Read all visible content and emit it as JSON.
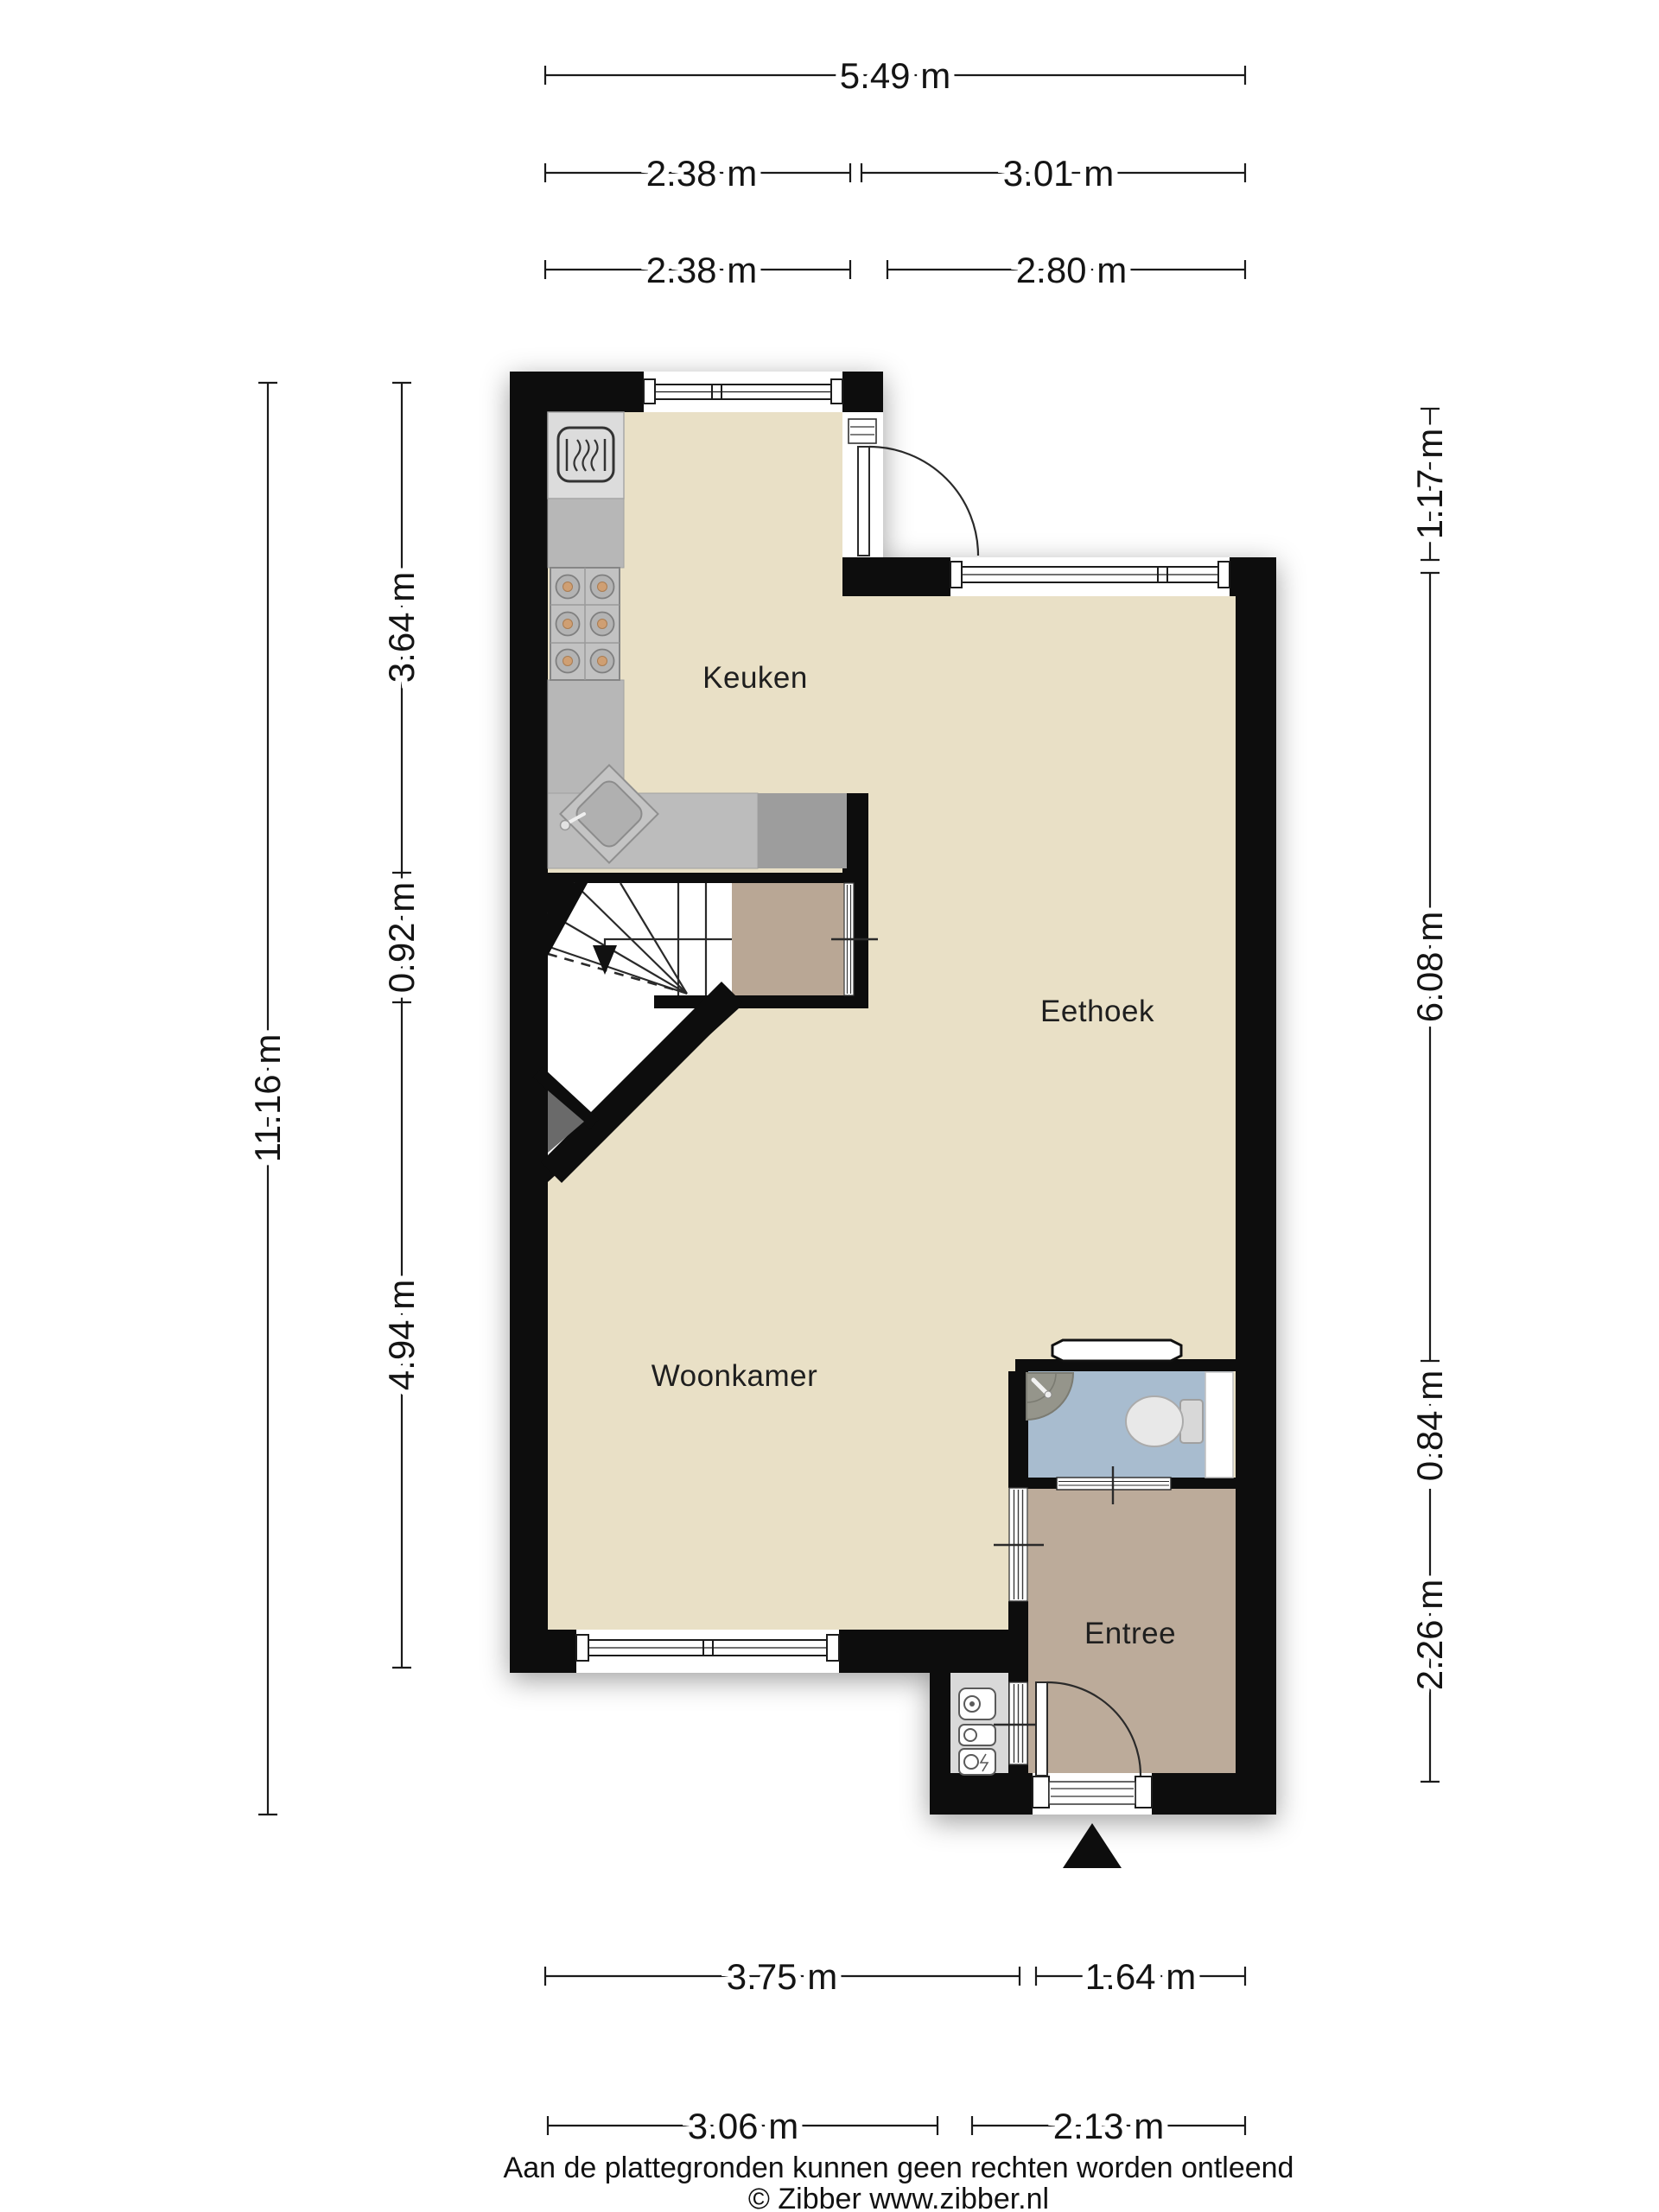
{
  "floor_plan": {
    "rooms": {
      "kitchen": "Keuken",
      "dining": "Eethoek",
      "living": "Woonkamer",
      "entry": "Entree"
    },
    "dimensions": {
      "top_total": "5.49 m",
      "top_left_a": "2.38 m",
      "top_right_a": "3.01 m",
      "top_left_b": "2.38 m",
      "top_right_b": "2.80 m",
      "left_total": "11.16 m",
      "left_kitchen": "3.64 m",
      "left_stairs": "0.92 m",
      "left_living": "4.94 m",
      "right_step": "1.17 m",
      "right_dining": "6.08 m",
      "right_toilet": "0.84 m",
      "right_entry": "2.26 m",
      "bottom_living_a": "3.75 m",
      "bottom_entry_a": "1.64 m",
      "bottom_living_b": "3.06 m",
      "bottom_entry_b": "2.13 m"
    },
    "footer": {
      "disclaimer": "Aan de plattegronden kunnen geen rechten worden ontleend",
      "copyright": "© Zibber www.zibber.nl"
    },
    "colors": {
      "wall": "#0d0d0d",
      "floor_main": "#e9e0c6",
      "floor_entry": "#bcab9a",
      "floor_closet": "#b9a795",
      "floor_toilet": "#a8bccf",
      "floor_meter": "#d9d9d9",
      "counter": "#b9b9b9",
      "counter_light": "#dcdcdc",
      "counter_dark": "#9d9d9d",
      "stairs": "#ffffff"
    }
  }
}
